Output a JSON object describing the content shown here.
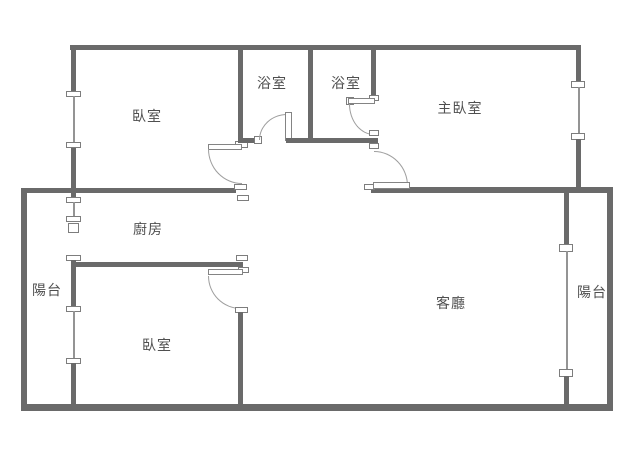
{
  "plan": {
    "type": "apartment-floor-plan",
    "rooms": {
      "bedroom_top": "臥室",
      "bathroom_left": "浴室",
      "bathroom_right": "浴室",
      "master_bedroom": "主臥室",
      "kitchen": "廚房",
      "balcony_left": "陽台",
      "bedroom_bottom": "臥室",
      "living_room": "客廳",
      "balcony_right": "陽台"
    },
    "colors": {
      "wall": "#6a6a6a",
      "window_line": "#949494",
      "door_arc": "#9e9e9e",
      "label_text": "#4f4f4f",
      "background": "#ffffff"
    }
  }
}
